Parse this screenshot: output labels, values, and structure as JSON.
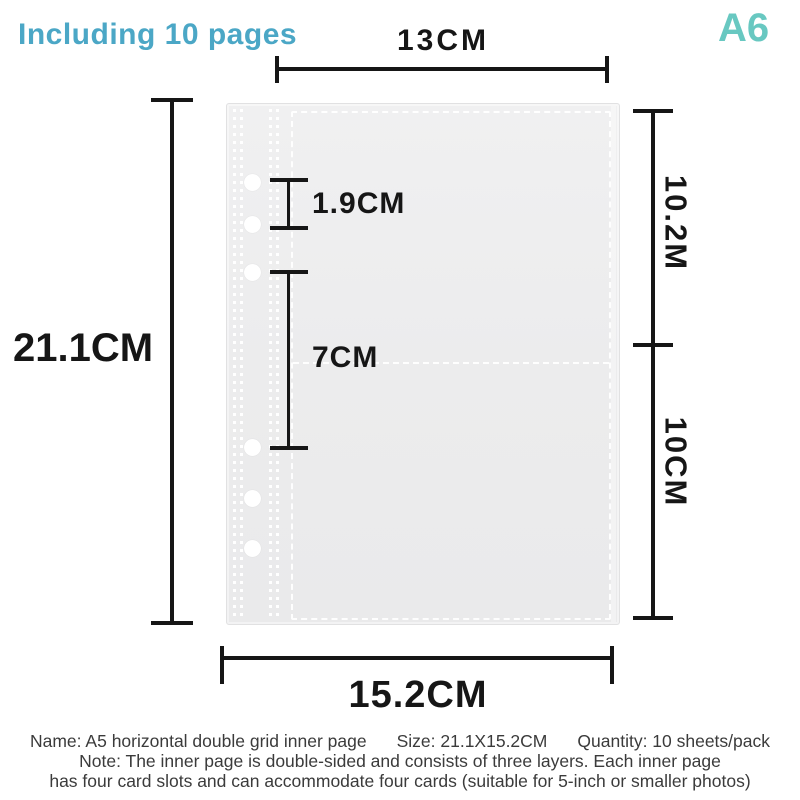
{
  "header": {
    "pages_note": "Including 10 pages",
    "pages_note_color": "#4BA7C6",
    "size_code": "A6",
    "size_code_color": "#68C8C1"
  },
  "dimensions": {
    "line_color": "#161616",
    "top_width": "13CM",
    "overall_height": "21.1CM",
    "hole_gap": "1.9CM",
    "pocket_height": "7CM",
    "upper_section": "10.2M",
    "lower_section": "10CM",
    "overall_width": "15.2CM"
  },
  "product": {
    "sleeve_color": "#ECECED",
    "stitch_color": "#FFFFFF",
    "hole_count": 6
  },
  "footer": {
    "name": "Name: A5 horizontal double grid inner page",
    "size": "Size: 21.1X15.2CM",
    "quantity": "Quantity: 10 sheets/pack",
    "note_line1": "Note: The inner page is double-sided and consists of three layers. Each inner page",
    "note_line2": "has four card slots and can accommodate four cards (suitable for 5-inch or smaller photos)"
  }
}
